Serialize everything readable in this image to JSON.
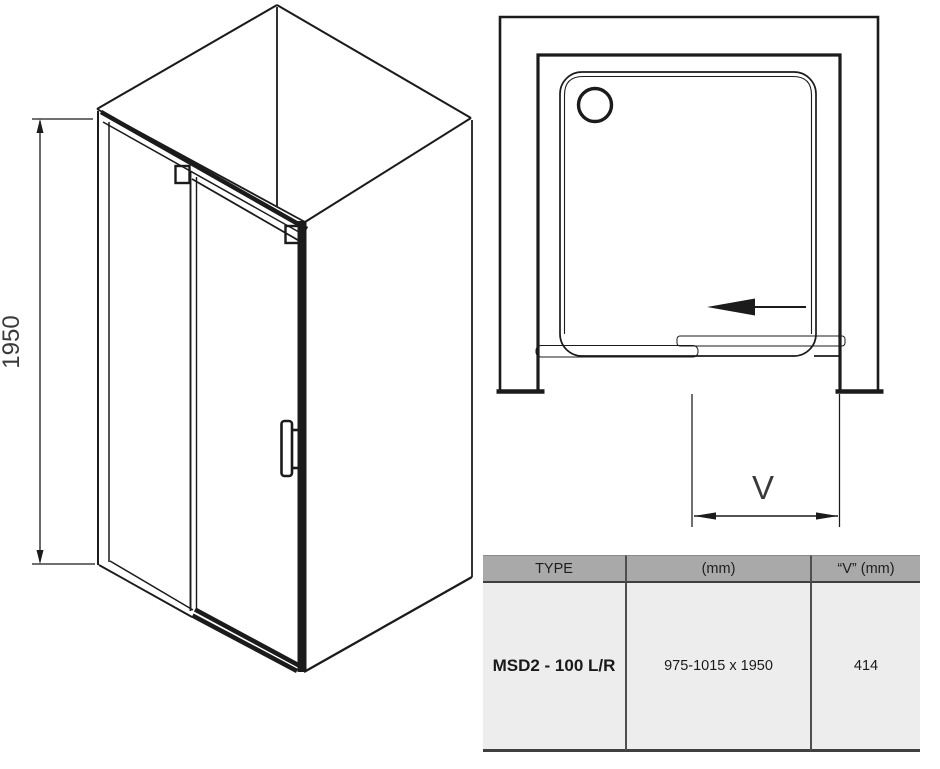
{
  "colors": {
    "line": "#1b1b1b",
    "table_header_bg": "#a9a9a9",
    "table_row_bg": "#ededed",
    "table_border": "#3f3f3f"
  },
  "iso_view": {
    "height_dim": "1950"
  },
  "plan_view": {
    "width_dim_label": "V"
  },
  "spec_table": {
    "headers": {
      "type": "TYPE",
      "size": "(mm)",
      "v": "“V” (mm)"
    },
    "row": {
      "type": "MSD2 - 100 L/R",
      "size": "975-1015 x 1950",
      "v": "414"
    }
  }
}
